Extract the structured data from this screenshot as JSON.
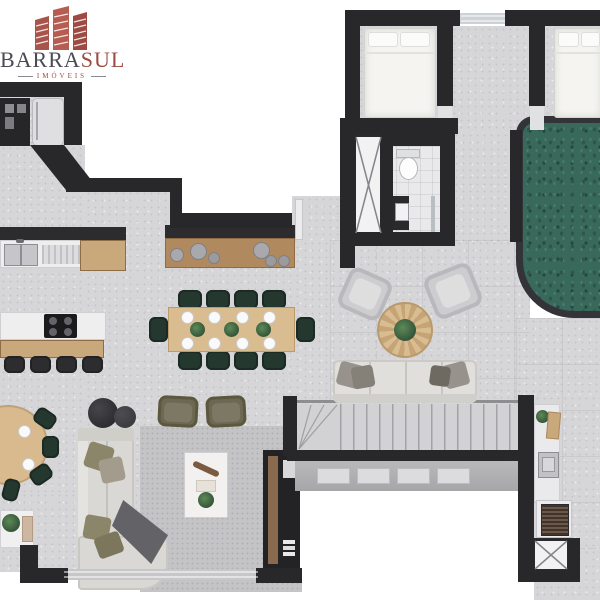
{
  "logo": {
    "brand_primary": "BARRA",
    "brand_accent": "SUL",
    "tagline": "IMÓVEIS",
    "icon": "buildings-icon"
  },
  "palette": {
    "brand_maroon": "#9C4A42",
    "brand_gray": "#4B4B55",
    "wall": "#28282B",
    "floor": "#D6D6D8",
    "pool_water": "#3C6B5C",
    "wood": "#C9A87C",
    "upholstery_green": "#24382F",
    "rug": "#C4C4C7"
  },
  "plan": {
    "type": "apartment-floor-plan-top-view",
    "areas": [
      "kitchen",
      "dining",
      "living",
      "entry",
      "hall",
      "bedroom-1",
      "bedroom-2",
      "bathroom",
      "stairs",
      "terrace-lounge",
      "pool",
      "gourmet-grill",
      "service-shaft-1",
      "service-shaft-2"
    ],
    "furniture": {
      "dining_chairs": 10,
      "bar_stools": 4,
      "sofas": 2,
      "lounge_armchairs": 4,
      "beds": 2,
      "round_tables": 2
    }
  }
}
